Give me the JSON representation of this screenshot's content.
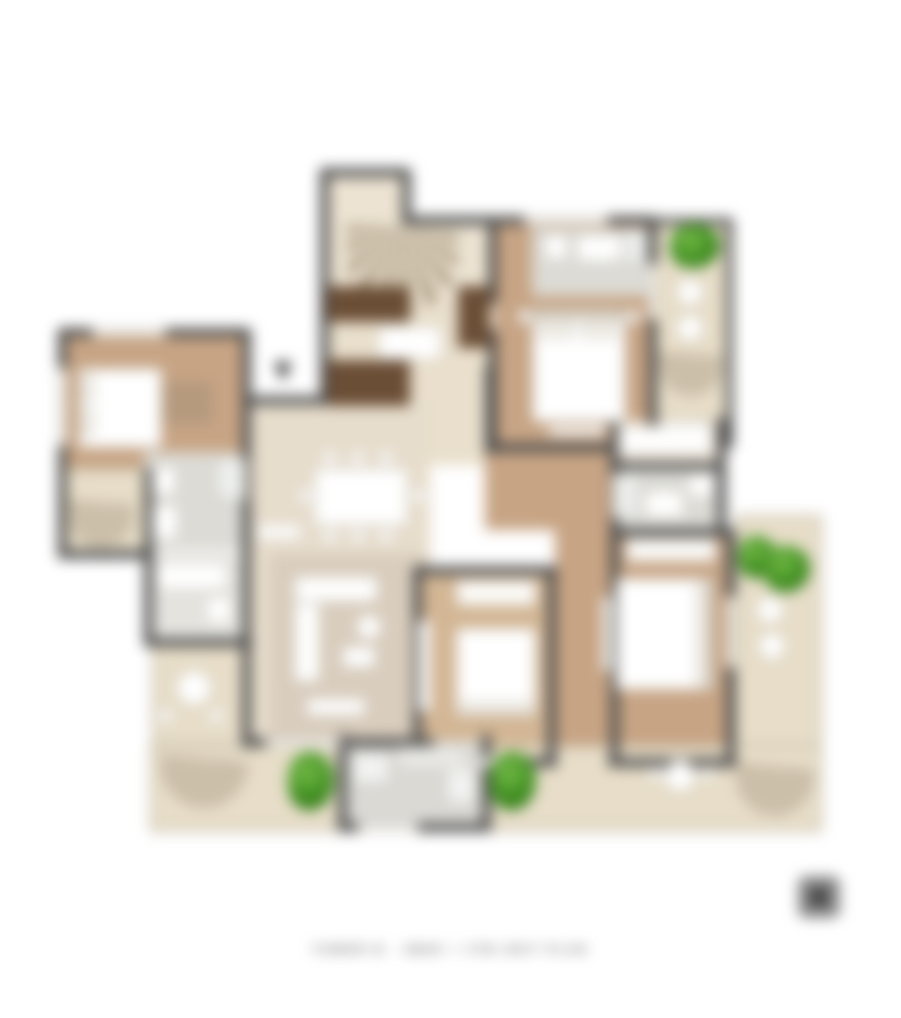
{
  "caption": {
    "text": "TOWER B - 3BHK + 3TB UNIT PLAN"
  },
  "logo": {
    "label": "brand-logo"
  },
  "palette": {
    "wall": "#4d4d4d",
    "wood": "#c7a484",
    "wood_light": "#d3b694",
    "tile_gray": "#dcdbd5",
    "terrace": "#e7ddc8",
    "cream": "#ece3d2",
    "counter_dark": "#6b4e36",
    "plant_green": "#3f8d20",
    "furniture": "#ffffff"
  },
  "plan": {
    "rooms": [
      {
        "n": "bedroom-1-floor",
        "x": 2,
        "y": 164,
        "w": 186,
        "h": 216,
        "f": "#c7a484"
      },
      {
        "n": "balcony-left-floor",
        "x": 2,
        "y": 300,
        "w": 88,
        "h": 88,
        "f": "#e7ddc8",
        "b": "2px solid #b9b19f"
      },
      {
        "n": "bath-1-floor",
        "x": 86,
        "y": 284,
        "w": 104,
        "h": 98,
        "f": "#dcdbd5"
      },
      {
        "n": "bath-2-floor",
        "x": 92,
        "y": 386,
        "w": 92,
        "h": 88,
        "f": "#e4e3de"
      },
      {
        "n": "terrace-left-floor",
        "x": 94,
        "y": 474,
        "w": 98,
        "h": 104,
        "f": "#e7ddc8",
        "b": "2px solid #b9b19f"
      },
      {
        "n": "foyer-floor",
        "x": 268,
        "y": 6,
        "w": 82,
        "h": 126,
        "f": "#ece3d2"
      },
      {
        "n": "foyer-wide-floor",
        "x": 268,
        "y": 52,
        "w": 166,
        "h": 80,
        "f": "#ece3d2"
      },
      {
        "n": "kitchen-floor",
        "x": 268,
        "y": 132,
        "w": 166,
        "h": 165,
        "f": "#e9dfcc"
      },
      {
        "n": "dining-living-floor",
        "x": 190,
        "y": 232,
        "w": 182,
        "h": 342,
        "f": "#e7ddcc"
      },
      {
        "n": "living-rug-floor",
        "x": 212,
        "y": 386,
        "w": 160,
        "h": 188,
        "f": "#d9cdbd"
      },
      {
        "n": "corridor-floor",
        "x": 427,
        "y": 284,
        "w": 125,
        "h": 78,
        "f": "#c7a484"
      },
      {
        "n": "corridor-vertical-floor",
        "x": 497,
        "y": 284,
        "w": 55,
        "h": 308,
        "f": "#c7a484"
      },
      {
        "n": "bedroom-2-floor",
        "x": 437,
        "y": 55,
        "w": 160,
        "h": 222,
        "f": "#c7a484"
      },
      {
        "n": "bath-3-floor",
        "x": 474,
        "y": 60,
        "w": 120,
        "h": 68,
        "f": "#dcdbd5"
      },
      {
        "n": "balcony-2-floor",
        "x": 597,
        "y": 55,
        "w": 77,
        "h": 222,
        "f": "#e7ddc8",
        "b": "2px solid #b9b19f"
      },
      {
        "n": "ac-ledge-floor",
        "x": 597,
        "y": 248,
        "w": 77,
        "h": 30,
        "f": "#e2d8c3"
      },
      {
        "n": "dressing-floor",
        "x": 552,
        "y": 252,
        "w": 114,
        "h": 46,
        "f": "#eae0d0"
      },
      {
        "n": "bath-4-floor",
        "x": 552,
        "y": 298,
        "w": 114,
        "h": 66,
        "f": "#dcdbd5"
      },
      {
        "n": "bedroom-4-floor",
        "x": 552,
        "y": 364,
        "w": 125,
        "h": 230,
        "f": "#c7a484"
      },
      {
        "n": "bedroom-3-floor",
        "x": 357,
        "y": 404,
        "w": 140,
        "h": 190,
        "f": "#d3b694"
      },
      {
        "n": "terrace-right-floor",
        "x": 677,
        "y": 347,
        "w": 87,
        "h": 317,
        "f": "#e7ddc8",
        "b": "2px solid #b9b19f"
      },
      {
        "n": "terrace-bottom-floor",
        "x": 92,
        "y": 577,
        "w": 672,
        "h": 87,
        "f": "#e7ddc8",
        "b": "2px solid #b9b19f"
      },
      {
        "n": "utility-floor",
        "x": 287,
        "y": 572,
        "w": 140,
        "h": 88,
        "f": "#dad9d4"
      }
    ],
    "walls": [
      [
        0,
        160,
        192,
        9
      ],
      [
        0,
        160,
        9,
        230
      ],
      [
        0,
        382,
        96,
        9
      ],
      [
        86,
        300,
        9,
        88
      ],
      [
        184,
        160,
        9,
        420
      ],
      [
        86,
        386,
        9,
        88
      ],
      [
        86,
        470,
        108,
        9
      ],
      [
        190,
        228,
        84,
        9
      ],
      [
        262,
        0,
        90,
        9
      ],
      [
        262,
        4,
        9,
        233
      ],
      [
        344,
        4,
        9,
        50
      ],
      [
        344,
        48,
        254,
        9
      ],
      [
        430,
        52,
        9,
        84
      ],
      [
        430,
        162,
        9,
        122
      ],
      [
        590,
        52,
        9,
        232
      ],
      [
        668,
        50,
        7,
        230
      ],
      [
        597,
        50,
        78,
        7
      ],
      [
        427,
        275,
        172,
        9
      ],
      [
        427,
        198,
        9,
        88
      ],
      [
        552,
        250,
        9,
        118
      ],
      [
        659,
        250,
        9,
        118
      ],
      [
        552,
        294,
        115,
        8
      ],
      [
        552,
        360,
        125,
        9
      ],
      [
        668,
        364,
        9,
        235
      ],
      [
        552,
        364,
        9,
        235
      ],
      [
        357,
        398,
        142,
        9
      ],
      [
        355,
        398,
        9,
        200
      ],
      [
        489,
        398,
        9,
        200
      ],
      [
        355,
        590,
        144,
        9
      ],
      [
        550,
        590,
        129,
        9
      ],
      [
        184,
        570,
        192,
        9
      ],
      [
        280,
        566,
        9,
        98
      ],
      [
        424,
        566,
        9,
        98
      ],
      [
        280,
        655,
        152,
        9
      ]
    ],
    "windows": [
      [
        34,
        160,
        74,
        9
      ],
      [
        0,
        200,
        9,
        78
      ],
      [
        466,
        48,
        84,
        9
      ],
      [
        590,
        96,
        9,
        56
      ],
      [
        668,
        428,
        9,
        72
      ],
      [
        388,
        590,
        72,
        9
      ],
      [
        208,
        570,
        76,
        9
      ],
      [
        300,
        655,
        60,
        9
      ]
    ],
    "fans": [
      {
        "n": "foyer-door-arc",
        "x": 288,
        "y": 58,
        "w": 112,
        "h": 86
      },
      {
        "n": "balcony-left-awning",
        "x": 10,
        "y": 334,
        "w": 66,
        "h": 46
      },
      {
        "n": "balcony-2-awning",
        "x": 600,
        "y": 186,
        "w": 66,
        "h": 42
      },
      {
        "n": "terrace-bottom-left-awning",
        "x": 102,
        "y": 590,
        "w": 88,
        "h": 50
      },
      {
        "n": "terrace-bottom-right-awning",
        "x": 678,
        "y": 598,
        "w": 78,
        "h": 50
      }
    ],
    "furniture": [
      {
        "n": "bed-1",
        "x": 20,
        "y": 200,
        "w": 84,
        "h": 80
      },
      {
        "n": "bed-1-pillow",
        "x": 22,
        "y": 206,
        "w": 14,
        "h": 28,
        "f": "#f0ede6"
      },
      {
        "n": "bed-1-pillow-2",
        "x": 22,
        "y": 240,
        "w": 14,
        "h": 28,
        "f": "#f0ede6"
      },
      {
        "n": "wardrobe-1",
        "x": 104,
        "y": 214,
        "w": 50,
        "h": 42,
        "f": "#b59a7e",
        "b": "none"
      },
      {
        "n": "shower-1",
        "x": 158,
        "y": 290,
        "w": 30,
        "h": 42,
        "f": "#eef0ee"
      },
      {
        "n": "toilet-1",
        "x": 94,
        "y": 298,
        "w": 24,
        "h": 30
      },
      {
        "n": "vanity-1",
        "x": 94,
        "y": 336,
        "w": 26,
        "h": 36
      },
      {
        "n": "vanity-2",
        "x": 98,
        "y": 394,
        "w": 72,
        "h": 28
      },
      {
        "n": "toilet-2",
        "x": 148,
        "y": 428,
        "w": 26,
        "h": 28
      },
      {
        "n": "table-terrace-left",
        "x": 118,
        "y": 502,
        "w": 36,
        "h": 36,
        "r": "50%"
      },
      {
        "n": "chair-terrace-left-1",
        "x": 100,
        "y": 540,
        "w": 16,
        "h": 16,
        "r": "50%"
      },
      {
        "n": "chair-terrace-left-2",
        "x": 150,
        "y": 540,
        "w": 16,
        "h": 16,
        "r": "50%"
      },
      {
        "n": "kitchen-counter-top",
        "x": 270,
        "y": 118,
        "w": 82,
        "h": 36,
        "f": "#6b4e36",
        "b": "none"
      },
      {
        "n": "kitchen-counter-right",
        "x": 400,
        "y": 118,
        "w": 32,
        "h": 62,
        "f": "#6b4e36",
        "b": "none"
      },
      {
        "n": "kitchen-counter-low",
        "x": 270,
        "y": 192,
        "w": 82,
        "h": 46,
        "f": "#6b4e36",
        "b": "none"
      },
      {
        "n": "kitchen-island",
        "x": 320,
        "y": 158,
        "w": 64,
        "h": 34
      },
      {
        "n": "dining-table",
        "x": 256,
        "y": 300,
        "w": 94,
        "h": 58
      },
      {
        "n": "dining-chair-1",
        "x": 264,
        "y": 282,
        "w": 16,
        "h": 16,
        "r": "50%"
      },
      {
        "n": "dining-chair-2",
        "x": 292,
        "y": 282,
        "w": 16,
        "h": 16,
        "r": "50%"
      },
      {
        "n": "dining-chair-3",
        "x": 320,
        "y": 282,
        "w": 16,
        "h": 16,
        "r": "50%"
      },
      {
        "n": "dining-chair-4",
        "x": 264,
        "y": 360,
        "w": 16,
        "h": 16,
        "r": "50%"
      },
      {
        "n": "dining-chair-5",
        "x": 292,
        "y": 360,
        "w": 16,
        "h": 16,
        "r": "50%"
      },
      {
        "n": "dining-chair-6",
        "x": 320,
        "y": 360,
        "w": 16,
        "h": 16,
        "r": "50%"
      },
      {
        "n": "dining-chair-7",
        "x": 240,
        "y": 320,
        "w": 16,
        "h": 16,
        "r": "50%"
      },
      {
        "n": "dining-chair-8",
        "x": 352,
        "y": 320,
        "w": 16,
        "h": 16,
        "r": "50%"
      },
      {
        "n": "crockery-unit",
        "x": 198,
        "y": 356,
        "w": 46,
        "h": 16
      },
      {
        "n": "sofa-seat",
        "x": 236,
        "y": 408,
        "w": 84,
        "h": 26
      },
      {
        "n": "sofa-chaise",
        "x": 236,
        "y": 434,
        "w": 26,
        "h": 80
      },
      {
        "n": "pouf",
        "x": 298,
        "y": 446,
        "w": 26,
        "h": 26,
        "r": "50%"
      },
      {
        "n": "coffee-table",
        "x": 284,
        "y": 478,
        "w": 34,
        "h": 22
      },
      {
        "n": "tv-console-living",
        "x": 248,
        "y": 530,
        "w": 60,
        "h": 18
      },
      {
        "n": "bed-2",
        "x": 474,
        "y": 140,
        "w": 94,
        "h": 114
      },
      {
        "n": "bed-2-headboard",
        "x": 474,
        "y": 140,
        "w": 94,
        "h": 12,
        "f": "#d6cfc2"
      },
      {
        "n": "bed-2-pillow-1",
        "x": 480,
        "y": 154,
        "w": 36,
        "h": 16,
        "f": "#f0ede6"
      },
      {
        "n": "bed-2-pillow-2",
        "x": 524,
        "y": 154,
        "w": 36,
        "h": 16,
        "f": "#f0ede6"
      },
      {
        "n": "bed-2-bench",
        "x": 490,
        "y": 258,
        "w": 58,
        "h": 10
      },
      {
        "n": "nightstand-2a",
        "x": 460,
        "y": 142,
        "w": 13,
        "h": 13
      },
      {
        "n": "nightstand-2b",
        "x": 569,
        "y": 142,
        "w": 13,
        "h": 13
      },
      {
        "n": "vanity-3",
        "x": 518,
        "y": 66,
        "w": 46,
        "h": 28
      },
      {
        "n": "toilet-3",
        "x": 486,
        "y": 66,
        "w": 24,
        "h": 26
      },
      {
        "n": "shower-3",
        "x": 564,
        "y": 62,
        "w": 26,
        "h": 34,
        "f": "#eceeec"
      },
      {
        "n": "chair-balcony-2a",
        "x": 618,
        "y": 110,
        "w": 28,
        "h": 28,
        "r": "50%"
      },
      {
        "n": "chair-balcony-2b",
        "x": 618,
        "y": 146,
        "w": 28,
        "h": 28,
        "r": "50%"
      },
      {
        "n": "ac-unit",
        "x": 604,
        "y": 252,
        "w": 46,
        "h": 18
      },
      {
        "n": "dressing-desk",
        "x": 560,
        "y": 258,
        "w": 94,
        "h": 28
      },
      {
        "n": "vanity-4",
        "x": 586,
        "y": 322,
        "w": 40,
        "h": 28
      },
      {
        "n": "toilet-4",
        "x": 630,
        "y": 306,
        "w": 26,
        "h": 24
      },
      {
        "n": "shower-4",
        "x": 554,
        "y": 306,
        "w": 28,
        "h": 44,
        "f": "#eceeec"
      },
      {
        "n": "wardrobe-master",
        "x": 568,
        "y": 370,
        "w": 90,
        "h": 24,
        "f": "#fcfbf8"
      },
      {
        "n": "bed-master",
        "x": 558,
        "y": 410,
        "w": 94,
        "h": 112
      },
      {
        "n": "bed-master-pillows",
        "x": 638,
        "y": 414,
        "w": 12,
        "h": 104,
        "f": "#f0ede6"
      },
      {
        "n": "bed-master-headboard",
        "x": 650,
        "y": 410,
        "w": 6,
        "h": 112,
        "f": "#d6cfc2"
      },
      {
        "n": "bench-master",
        "x": 544,
        "y": 428,
        "w": 10,
        "h": 76
      },
      {
        "n": "wardrobe-3",
        "x": 398,
        "y": 412,
        "w": 80,
        "h": 26,
        "f": "#fcfbf8"
      },
      {
        "n": "bed-3",
        "x": 398,
        "y": 460,
        "w": 80,
        "h": 88
      },
      {
        "n": "bed-3-pillows",
        "x": 402,
        "y": 534,
        "w": 72,
        "h": 12,
        "f": "#f0ede6"
      },
      {
        "n": "tv-unit-3",
        "x": 360,
        "y": 452,
        "w": 13,
        "h": 92
      },
      {
        "n": "washer-utility",
        "x": 294,
        "y": 584,
        "w": 38,
        "h": 32,
        "f": "#f2f3f2"
      },
      {
        "n": "sink-utility",
        "x": 338,
        "y": 578,
        "w": 72,
        "h": 24,
        "f": "#e9e9e6"
      },
      {
        "n": "utility-cabinet",
        "x": 388,
        "y": 600,
        "w": 30,
        "h": 36,
        "f": "#f2f3f2"
      },
      {
        "n": "table-terrace-bottom",
        "x": 606,
        "y": 592,
        "w": 32,
        "h": 32,
        "r": "50%"
      },
      {
        "n": "chair-terrace-bottom-1",
        "x": 642,
        "y": 598,
        "w": 15,
        "h": 15,
        "r": "50%"
      },
      {
        "n": "chair-terrace-bottom-2",
        "x": 590,
        "y": 598,
        "w": 15,
        "h": 15,
        "r": "50%"
      },
      {
        "n": "chair-terrace-right-1",
        "x": 698,
        "y": 428,
        "w": 28,
        "h": 28,
        "r": "50%"
      },
      {
        "n": "chair-terrace-right-2",
        "x": 700,
        "y": 464,
        "w": 28,
        "h": 28,
        "r": "50%"
      }
    ],
    "plants": [
      [
        230,
        584,
        46,
        58
      ],
      [
        432,
        584,
        46,
        58
      ],
      [
        612,
        56,
        50,
        44
      ],
      [
        680,
        368,
        38,
        42
      ],
      [
        706,
        378,
        46,
        46
      ]
    ],
    "arrow": [
      216,
      194
    ]
  }
}
